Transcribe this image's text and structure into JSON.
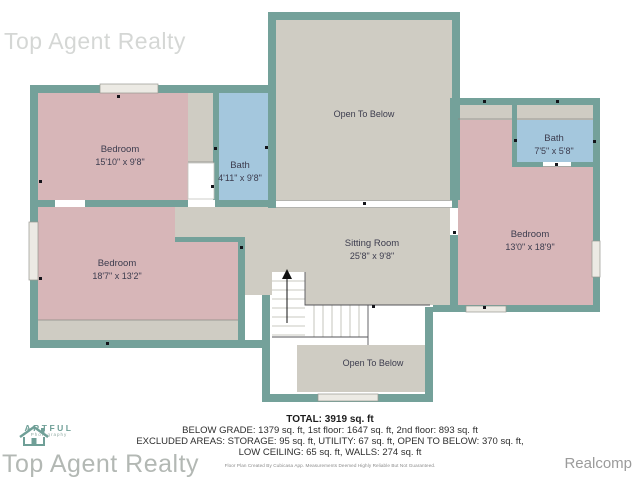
{
  "watermarks": {
    "top_left": "Top Agent Realty",
    "bottom_left": "Top Agent Realty",
    "provider": "Realcomp"
  },
  "logo": {
    "name": "ARTFUL",
    "subtitle": "Photography"
  },
  "rooms": {
    "open_to_below_top": {
      "name": "Open To Below"
    },
    "bedroom1": {
      "name": "Bedroom",
      "dims": "15'10\" x 9'8\""
    },
    "bath1": {
      "name": "Bath",
      "dims": "4'11\" x 9'8\""
    },
    "bath2": {
      "name": "Bath",
      "dims": "7'5\" x 5'8\""
    },
    "bedroom2": {
      "name": "Bedroom",
      "dims": "18'7\" x 13'2\""
    },
    "bedroom3": {
      "name": "Bedroom",
      "dims": "13'0\" x 18'9\""
    },
    "sitting": {
      "name": "Sitting Room",
      "dims": "25'8\" x 9'8\""
    },
    "open_to_below_bottom": {
      "name": "Open To Below"
    }
  },
  "summary": {
    "total": "TOTAL: 3919 sq. ft",
    "line1": "BELOW GRADE: 1379 sq. ft, 1st floor: 1647 sq. ft, 2nd floor: 893 sq. ft",
    "line2": "EXCLUDED AREAS: STORAGE: 95 sq. ft, UTILITY: 67 sq. ft, OPEN TO BELOW: 370 sq. ft,",
    "line3": "LOW CEILING: 65 sq. ft, WALLS: 274 sq. ft",
    "disclaimer": "Floor Plan Created By Cubicasa App. Measurements Deemed Highly Reliable But Not Guaranteed."
  },
  "colors": {
    "wall": "#74a19a",
    "bedroom": "#d7b6b8",
    "bath": "#a4c7dd",
    "floor": "#cfccc3",
    "label": "#3c3c4e",
    "logo_teal": "#6f9f97",
    "watermark_gray": "#b3b8b4"
  }
}
